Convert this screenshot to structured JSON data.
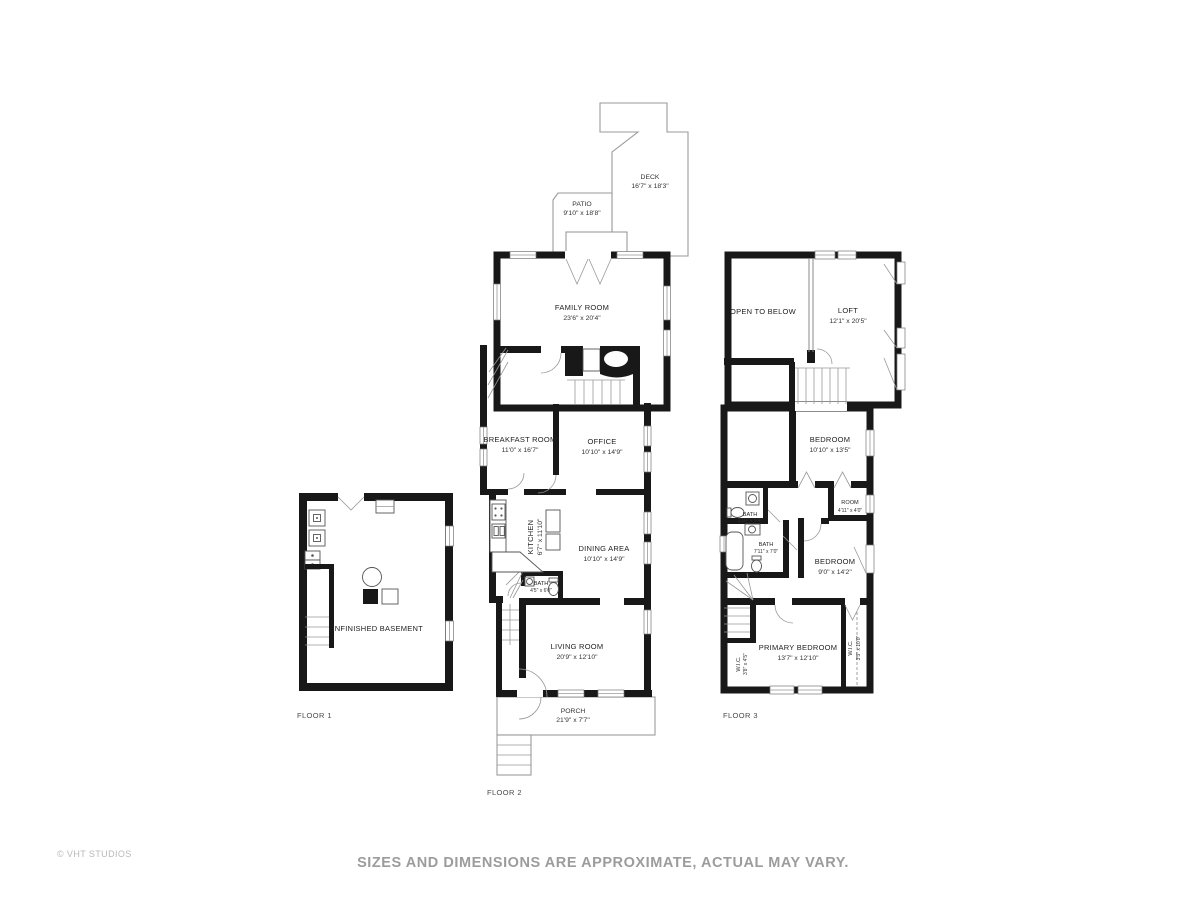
{
  "page": {
    "disclaimer": "SIZES AND DIMENSIONS ARE APPROXIMATE, ACTUAL MAY VARY.",
    "copyright": "© VHT STUDIOS"
  },
  "floors": {
    "f1": {
      "label": "FLOOR 1",
      "rooms": {
        "basement": {
          "name": "UNFINISHED BASEMENT"
        }
      }
    },
    "f2": {
      "label": "FLOOR 2",
      "rooms": {
        "deck": {
          "name": "DECK",
          "dims": "16'7\" x 18'3\""
        },
        "patio": {
          "name": "PATIO",
          "dims": "9'10\" x 18'8\""
        },
        "family_room": {
          "name": "FAMILY ROOM",
          "dims": "23'6\" x 20'4\""
        },
        "breakfast_room": {
          "name": "BREAKFAST ROOM",
          "dims": "11'0\" x 16'7\""
        },
        "office": {
          "name": "OFFICE",
          "dims": "10'10\" x 14'9\""
        },
        "kitchen": {
          "name": "KITCHEN",
          "dims": "6'7\" x 11'10\""
        },
        "dining_area": {
          "name": "DINING AREA",
          "dims": "10'10\" x 14'9\""
        },
        "bath": {
          "name": "BATH",
          "dims": "4'5\" x 6'0\""
        },
        "living_room": {
          "name": "LIVING ROOM",
          "dims": "20'9\" x 12'10\""
        },
        "porch": {
          "name": "PORCH",
          "dims": "21'9\" x 7'7\""
        }
      }
    },
    "f3": {
      "label": "FLOOR 3",
      "rooms": {
        "open_to_below": {
          "name": "OPEN TO BELOW"
        },
        "loft": {
          "name": "LOFT",
          "dims": "12'1\" x 20'5\""
        },
        "bedroom1": {
          "name": "BEDROOM",
          "dims": "10'10\" x 13'5\""
        },
        "room": {
          "name": "ROOM",
          "dims": "4'11\" x 4'0\""
        },
        "bath_small": {
          "name": "BATH",
          "dims": "3'10\" x 5'4\""
        },
        "bath_main": {
          "name": "BATH",
          "dims": "7'11\" x 7'0\""
        },
        "bedroom2": {
          "name": "BEDROOM",
          "dims": "9'0\" x 14'2\""
        },
        "primary_bedroom": {
          "name": "PRIMARY BEDROOM",
          "dims": "13'7\" x 12'10\""
        },
        "wic_left": {
          "name": "W.I.C.",
          "dims": "3'8\" x 4'5\""
        },
        "wic_right": {
          "name": "W.I.C.",
          "dims": "3'5\" x 10'0\""
        }
      }
    }
  }
}
